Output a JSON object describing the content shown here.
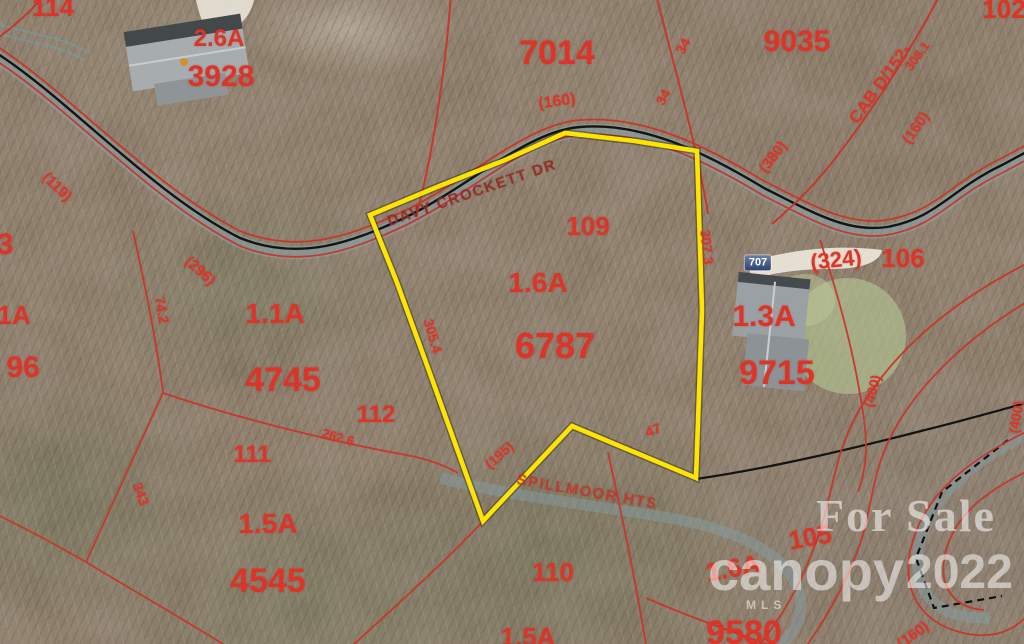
{
  "roads": {
    "davy_crockett_dr": "DAVY CROCKETT DR",
    "spillmoor_hts": "SPILLMOOR HTS"
  },
  "watermark": {
    "for_sale": "For Sale",
    "brand": "canopy",
    "mls": "MLS",
    "year": "2022"
  },
  "colors": {
    "subject_boundary_yellow": "#ffe400",
    "parcel_line_red": "#c8352b",
    "label_red": "#dd3429",
    "road_casing_teal": "#88a6b0",
    "road_centerline_black": "#111111"
  },
  "subject_parcel": {
    "street_number": "109",
    "acreage": "1.6A",
    "parcel_id": "6787",
    "dim_left": "305.4",
    "dim_right": "307.3",
    "dim_bottom": "47",
    "dim_notch": "(195)"
  },
  "parcels": {
    "northwest": {
      "street_number": "114",
      "acreage": "2.6A",
      "parcel_id": "3928"
    },
    "north": {
      "parcel_id": "7014",
      "plat": "(160)"
    },
    "northeast": {
      "parcel_id": "9035",
      "survey_ref": "CAB D/152-",
      "dim": "308.1",
      "plat": "(160)",
      "row": "(380)",
      "tick_a": "34",
      "tick_b": "34"
    },
    "far_northeast": {
      "street_number": "102"
    },
    "east": {
      "house_number": "707",
      "street_number": "106",
      "plat": "(324)",
      "acreage": "1.3A",
      "parcel_id": "9715",
      "row": "(400)",
      "row_edge": "(400)"
    },
    "west": {
      "acreage": "1.1A",
      "parcel_id": "4745",
      "dim_a": "(119)",
      "dim_b": "(296)",
      "dim_c": "74.2"
    },
    "west_edge": {
      "cut_a": "3",
      "cut_b": "1A",
      "cut_c": "96"
    },
    "south": {
      "street_number": "111",
      "acreage": "1.5A",
      "parcel_id": "4545",
      "dim": "343"
    },
    "south_neighbor": {
      "street_number": "112",
      "dim": "262.6"
    },
    "southeast": {
      "street_number": "110",
      "acreage": "1.5A"
    },
    "far_southeast": {
      "parcel_id": "9580",
      "acreage": "1.6A",
      "street_number": "105",
      "plat": "(160)"
    }
  }
}
